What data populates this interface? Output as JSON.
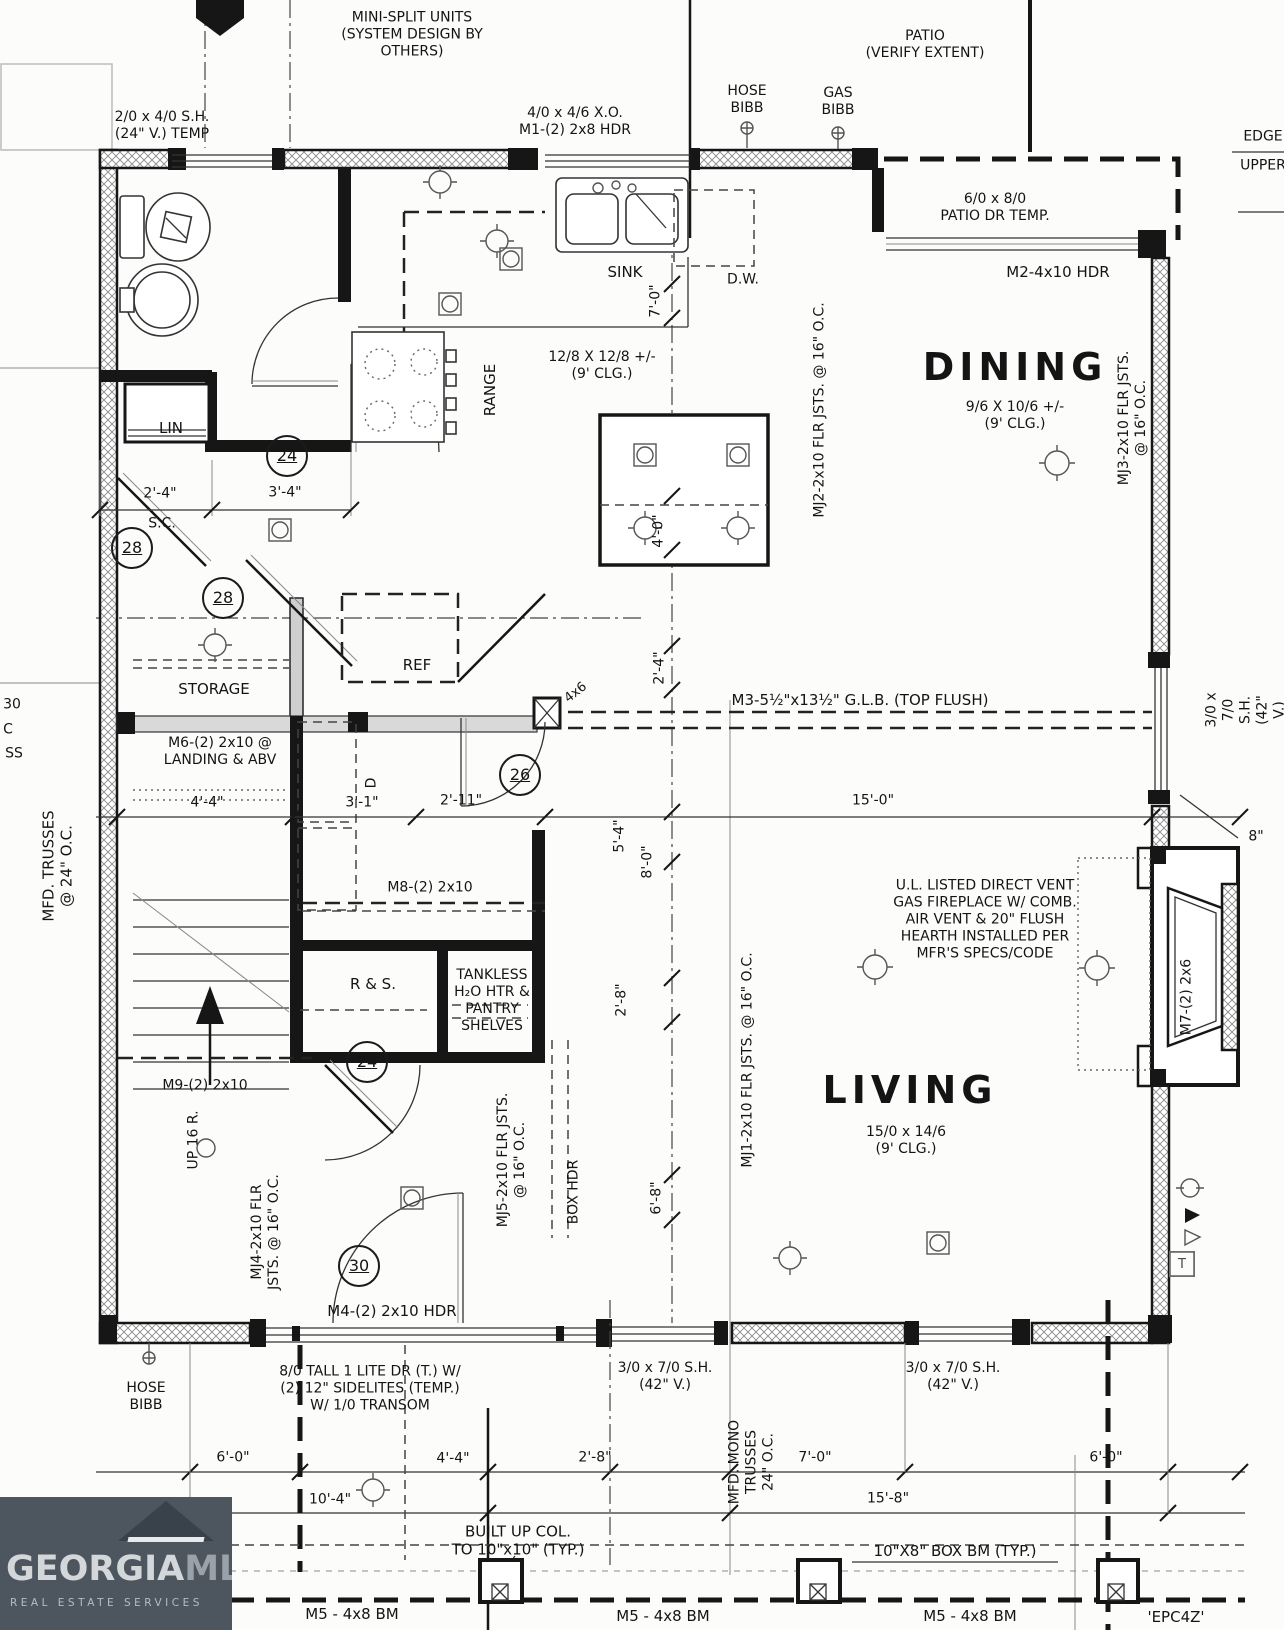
{
  "canvas": {
    "w": 1284,
    "h": 1630
  },
  "logo": {
    "brand_a": "GEORGIA",
    "brand_b": "MLS",
    "tagline": "REAL ESTATE SERVICES"
  },
  "rooms": [
    {
      "name": "DINING",
      "size": "9/6 X 10/6 +/-",
      "ceiling": "(9' CLG.)"
    },
    {
      "name": "LIVING",
      "size": "15/0 x 14/6",
      "ceiling": "(9' CLG.)"
    },
    {
      "name": "KITCHEN",
      "size": "12/8 X 12/8 +/-",
      "ceiling": "(9' CLG.)"
    },
    {
      "name": "STORAGE"
    }
  ],
  "labels": [
    {
      "n": "note-minisplit",
      "t": "MINI-SPLIT UNITS\n(SYSTEM DESIGN BY\nOTHERS)",
      "x": 412,
      "y": 35
    },
    {
      "n": "window-2040",
      "t": "2/0 x 4/0 S.H.\n(24\" V.) TEMP",
      "x": 162,
      "y": 126
    },
    {
      "n": "window-4046",
      "t": "4/0 x 4/6 X.O.\nM1-(2) 2x8 HDR",
      "x": 575,
      "y": 122
    },
    {
      "n": "hose-bibb-top",
      "t": "HOSE\nBIBB",
      "x": 747,
      "y": 100
    },
    {
      "n": "gas-bibb",
      "t": "GAS\nBIBB",
      "x": 838,
      "y": 102
    },
    {
      "n": "patio-note",
      "t": "PATIO\n(VERIFY EXTENT)",
      "x": 925,
      "y": 45
    },
    {
      "n": "edge-label",
      "t": "EDGE",
      "x": 1263,
      "y": 137
    },
    {
      "n": "upper-label",
      "t": "UPPER",
      "x": 1263,
      "y": 166
    },
    {
      "n": "patio-door",
      "t": "6/0 x 8/0\nPATIO DR TEMP.",
      "x": 995,
      "y": 208
    },
    {
      "n": "m2-hdr",
      "t": "M2-4x10 HDR",
      "x": 1058,
      "y": 272,
      "s": 15
    },
    {
      "n": "sink-label",
      "t": "SINK",
      "x": 625,
      "y": 272,
      "s": 15
    },
    {
      "n": "dw-label",
      "t": "D.W.",
      "x": 743,
      "y": 280
    },
    {
      "n": "dim-7-0",
      "t": "7'-0\"",
      "x": 656,
      "y": 301,
      "r": -90
    },
    {
      "n": "kitchen-size",
      "t": "12/8 X 12/8 +/-\n(9' CLG.)",
      "x": 602,
      "y": 366
    },
    {
      "n": "range-label",
      "t": "RANGE",
      "x": 490,
      "y": 390,
      "r": -90,
      "s": 15
    },
    {
      "n": "room-dining",
      "t": "DINING",
      "x": 1015,
      "y": 367,
      "s": 38,
      "b": 1,
      "ls": 5
    },
    {
      "n": "dining-size",
      "t": "9/6 X 10/6 +/-\n(9' CLG.)",
      "x": 1015,
      "y": 416
    },
    {
      "n": "mj2-joists",
      "t": "MJ2-2x10 FLR JSTS. @ 16\" O.C.",
      "x": 820,
      "y": 410,
      "r": -90
    },
    {
      "n": "mj3-joists",
      "t": "MJ3-2x10 FLR JSTS. @ 16\" O.C.",
      "x": 1133,
      "y": 418,
      "r": -90
    },
    {
      "n": "dim-4-0",
      "t": "4'-0\"",
      "x": 659,
      "y": 531,
      "r": -90
    },
    {
      "n": "lin-label",
      "t": "LIN",
      "x": 171,
      "y": 428,
      "s": 15
    },
    {
      "n": "keynote-24a",
      "t": "24",
      "x": 287,
      "y": 456,
      "c": 1
    },
    {
      "n": "dim-2-4a",
      "t": "2'-4\"",
      "x": 160,
      "y": 494
    },
    {
      "n": "dim-3-4",
      "t": "3'-4\"",
      "x": 285,
      "y": 493
    },
    {
      "n": "sc-label",
      "t": "S.C.",
      "x": 162,
      "y": 524
    },
    {
      "n": "keynote-28a",
      "t": "28",
      "x": 132,
      "y": 548,
      "c": 1
    },
    {
      "n": "keynote-28b",
      "t": "28",
      "x": 223,
      "y": 598,
      "c": 1
    },
    {
      "n": "storage-label",
      "t": "STORAGE",
      "x": 214,
      "y": 689,
      "s": 15
    },
    {
      "n": "ref-label",
      "t": "REF",
      "x": 417,
      "y": 665,
      "s": 15
    },
    {
      "n": "post-4x6-a",
      "t": "4x6",
      "x": 576,
      "y": 693,
      "r": -38,
      "s": 13
    },
    {
      "n": "dim-2-4b",
      "t": "2'-4\"",
      "x": 660,
      "y": 668,
      "r": -90
    },
    {
      "n": "m3-glb",
      "t": "M3-5½\"x13½\" G.L.B. (TOP FLUSH)",
      "x": 860,
      "y": 700,
      "s": 15
    },
    {
      "n": "m6-landing",
      "t": "M6-(2) 2x10 @\nLANDING & ABV",
      "x": 220,
      "y": 752
    },
    {
      "n": "dryer-label",
      "t": "D",
      "x": 372,
      "y": 783,
      "r": -90
    },
    {
      "n": "keynote-26",
      "t": "26",
      "x": 520,
      "y": 775,
      "c": 1
    },
    {
      "n": "dim-4-4a",
      "t": "4'-4\"",
      "x": 207,
      "y": 803
    },
    {
      "n": "dim-3-1",
      "t": "3'-1\"",
      "x": 362,
      "y": 803
    },
    {
      "n": "dim-2-11",
      "t": "2'-11\"",
      "x": 461,
      "y": 801
    },
    {
      "n": "dim-15-0",
      "t": "15'-0\"",
      "x": 873,
      "y": 801
    },
    {
      "n": "window-3070-right",
      "t": "3/0 x 7/0 S.H.\n(42\" V.)",
      "x": 1246,
      "y": 710,
      "r": -90
    },
    {
      "n": "dim-8in",
      "t": "8\"",
      "x": 1256,
      "y": 837
    },
    {
      "n": "mfd-trusses",
      "t": "MFD. TRUSSES\n@ 24\" O.C.",
      "x": 58,
      "y": 866,
      "r": -90,
      "s": 15
    },
    {
      "n": "dim-5-4",
      "t": "5'-4\"",
      "x": 620,
      "y": 836,
      "r": -90
    },
    {
      "n": "dim-8-0",
      "t": "8'-0\"",
      "x": 648,
      "y": 862,
      "r": -90
    },
    {
      "n": "fireplace-note",
      "t": "U.L. LISTED DIRECT VENT\nGAS FIREPLACE W/ COMB.\nAIR VENT & 20\" FLUSH\nHEARTH INSTALLED PER\nMFR'S SPECS/CODE",
      "x": 985,
      "y": 920
    },
    {
      "n": "m8-beam",
      "t": "M8-(2) 2x10",
      "x": 430,
      "y": 888
    },
    {
      "n": "mj1-joists",
      "t": "MJ1-2x10 FLR JSTS. @ 16\" O.C.",
      "x": 748,
      "y": 1060,
      "r": -90
    },
    {
      "n": "rs-label",
      "t": "R & S.",
      "x": 373,
      "y": 984,
      "s": 15
    },
    {
      "n": "tankless-note",
      "t": "TANKLESS\nH₂O HTR &\nPANTRY\nSHELVES",
      "x": 492,
      "y": 1001
    },
    {
      "n": "dim-2-8v",
      "t": "2'-8\"",
      "x": 622,
      "y": 1000,
      "r": -90
    },
    {
      "n": "keynote-24b",
      "t": "24",
      "x": 367,
      "y": 1062,
      "c": 1
    },
    {
      "n": "m7-beam",
      "t": "M7-(2) 2x6",
      "x": 1187,
      "y": 997,
      "r": -90
    },
    {
      "n": "room-living",
      "t": "LIVING",
      "x": 910,
      "y": 1090,
      "s": 38,
      "b": 1,
      "ls": 5
    },
    {
      "n": "living-size",
      "t": "15/0 x 14/6\n(9' CLG.)",
      "x": 906,
      "y": 1141
    },
    {
      "n": "m9-beam",
      "t": "M9-(2) 2x10",
      "x": 205,
      "y": 1086
    },
    {
      "n": "up-16r",
      "t": "UP 16 R.",
      "x": 194,
      "y": 1140,
      "r": -90
    },
    {
      "n": "dim-6-8",
      "t": "6'-8\"",
      "x": 657,
      "y": 1198,
      "r": -90
    },
    {
      "n": "mj4-joists",
      "t": "MJ4-2x10 FLR\nJSTS. @ 16\" O.C.",
      "x": 266,
      "y": 1232,
      "r": -90
    },
    {
      "n": "mj5-joists",
      "t": "MJ5-2x10 FLR JSTS.\n@ 16\" O.C.",
      "x": 512,
      "y": 1160,
      "r": -90
    },
    {
      "n": "box-hdr",
      "t": "BOX HDR",
      "x": 574,
      "y": 1192,
      "r": -90
    },
    {
      "n": "keynote-30",
      "t": "30",
      "x": 359,
      "y": 1266,
      "c": 1
    },
    {
      "n": "m4-hdr",
      "t": "M4-(2) 2x10 HDR",
      "x": 392,
      "y": 1311,
      "s": 15
    },
    {
      "n": "front-door-note",
      "t": "8/0 TALL 1 LITE DR (T.) W/\n(2) 12\" SIDELITES (TEMP.)\nW/ 1/0 TRANSOM",
      "x": 370,
      "y": 1389
    },
    {
      "n": "hose-bibb-bottom",
      "t": "HOSE\nBIBB",
      "x": 146,
      "y": 1397
    },
    {
      "n": "window-3070-a",
      "t": "3/0 x 7/0 S.H.\n(42\" V.)",
      "x": 665,
      "y": 1377
    },
    {
      "n": "window-3070-b",
      "t": "3/0 x 7/0 S.H.\n(42\" V.)",
      "x": 953,
      "y": 1377
    },
    {
      "n": "mono-trusses",
      "t": "MFD. MONO\nTRUSSES\n24\" O.C.",
      "x": 752,
      "y": 1462,
      "r": -90
    },
    {
      "n": "dim-6-0a",
      "t": "6'-0\"",
      "x": 233,
      "y": 1458
    },
    {
      "n": "dim-4-4b",
      "t": "4'-4\"",
      "x": 453,
      "y": 1459
    },
    {
      "n": "dim-2-8b",
      "t": "2'-8\"",
      "x": 595,
      "y": 1458
    },
    {
      "n": "dim-7-0b",
      "t": "7'-0\"",
      "x": 815,
      "y": 1458
    },
    {
      "n": "dim-6-0b",
      "t": "6'-0\"",
      "x": 1106,
      "y": 1458
    },
    {
      "n": "dim-10-4",
      "t": "10'-4\"",
      "x": 330,
      "y": 1500
    },
    {
      "n": "dim-15-8",
      "t": "15'-8\"",
      "x": 888,
      "y": 1499
    },
    {
      "n": "builtup-col",
      "t": "BUILT UP COL.\nTO 10\"x10\" (TYP.)",
      "x": 518,
      "y": 1541,
      "s": 15
    },
    {
      "n": "box-bm",
      "t": "10\"X8\" BOX BM (TYP.)",
      "x": 955,
      "y": 1551,
      "s": 15
    },
    {
      "n": "m5-bm-a",
      "t": "M5 - 4x8 BM",
      "x": 352,
      "y": 1614,
      "s": 15
    },
    {
      "n": "m5-bm-b",
      "t": "M5 - 4x8 BM",
      "x": 663,
      "y": 1616,
      "s": 15
    },
    {
      "n": "m5-bm-c",
      "t": "M5 - 4x8 BM",
      "x": 970,
      "y": 1616,
      "s": 15
    },
    {
      "n": "epc4z",
      "t": "'EPC4Z'",
      "x": 1176,
      "y": 1617,
      "s": 15
    },
    {
      "n": "edge-frag-a",
      "t": "30",
      "x": 12,
      "y": 705
    },
    {
      "n": "edge-frag-b",
      "t": "C",
      "x": 8,
      "y": 730
    },
    {
      "n": "edge-frag-c",
      "t": "SS",
      "x": 14,
      "y": 754
    },
    {
      "n": "thermostat",
      "t": "T",
      "x": 1182,
      "y": 1264,
      "bx": 1
    }
  ]
}
